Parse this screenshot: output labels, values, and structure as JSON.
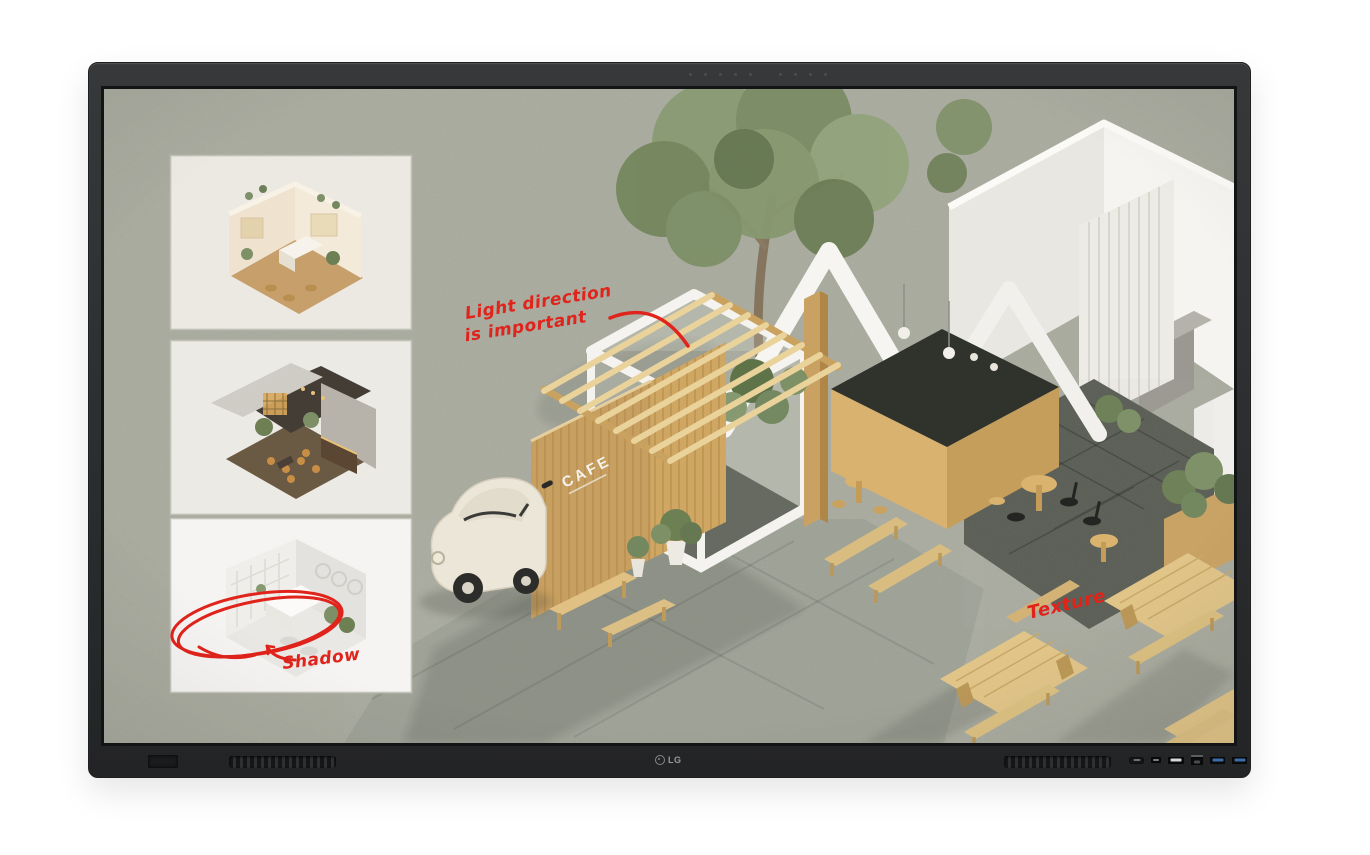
{
  "device": {
    "brand": "LG",
    "bezel_color": "#2c2e30",
    "front_ports": [
      "front-button",
      "small-port",
      "usb-port",
      "lan-port",
      "usb3-port",
      "usb3-port"
    ]
  },
  "screen": {
    "background_color": "#a8aa9d",
    "annotation_color": "#e0231b",
    "annotations": {
      "light_direction": {
        "line1": "Light direction",
        "line2": "is important"
      },
      "shadow": "Shadow",
      "texture": "Texture"
    },
    "scene": {
      "cafe_sign": "CAFE",
      "description": "Isometric cutaway render of a cafe with tree, vintage car, wooden pergola and outdoor picnic tables"
    },
    "thumbnails": [
      {
        "id": "warm-cafe",
        "description": "Warm two-storey cafe interior render"
      },
      {
        "id": "dark-restaurant",
        "description": "Dark moody restaurant interior render"
      },
      {
        "id": "white-studio",
        "description": "Bright white minimal interior render"
      }
    ]
  }
}
